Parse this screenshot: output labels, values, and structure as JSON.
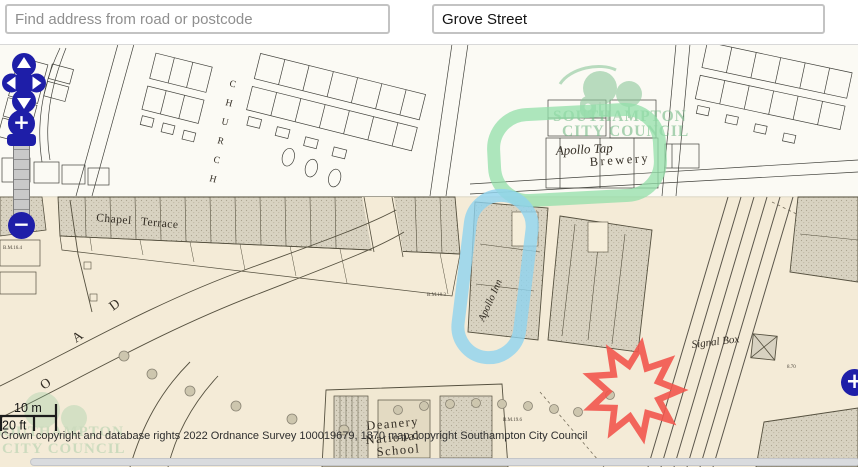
{
  "header": {
    "search_placeholder": "Find address from road or postcode",
    "road_value": "Grove Street"
  },
  "controls": {
    "zoom_in": "+",
    "zoom_out": "−",
    "add_marker": "+",
    "icons": {
      "pan": "pan-arrows-icon",
      "zoom_in": "plus-icon",
      "zoom_out": "minus-icon",
      "add_marker": "plus-icon"
    }
  },
  "scalebar": {
    "metric": "10 m",
    "imperial": "20 ft"
  },
  "attribution": "Crown copyright and database rights 2022 Ordnance Survey 100019679, 1870 map copyright Southampton City Council",
  "map": {
    "labels": {
      "chapel_terrace": "Chapel Terrace",
      "apollo_tap": "Apollo Tap",
      "brewery": "Brewery",
      "apollo_inn": "Apollo Inn",
      "signal_box": "Signal Box",
      "school_line1": "Deanery",
      "school_line2": "National",
      "school_line3": "School",
      "school_line4": "Infants",
      "road_letters": [
        "O",
        "A",
        "D"
      ],
      "church_letters": [
        "C",
        "H",
        "U",
        "R",
        "C",
        "H"
      ],
      "benchmarks": [
        "B.M.16.4",
        "B.M.10.3",
        "B.M.19.6",
        "8.70"
      ]
    },
    "watermark": {
      "line1": "SOUTHAMPTON",
      "line2": "CITY COUNCIL"
    },
    "colors": {
      "highlight_green": "#93dfa9",
      "highlight_blue": "#8fd3ef",
      "highlight_red": "#f2564e",
      "control_navy": "#1e1ea8",
      "map_beige": "#f4ebd7",
      "map_white": "#fbfaf4"
    }
  }
}
